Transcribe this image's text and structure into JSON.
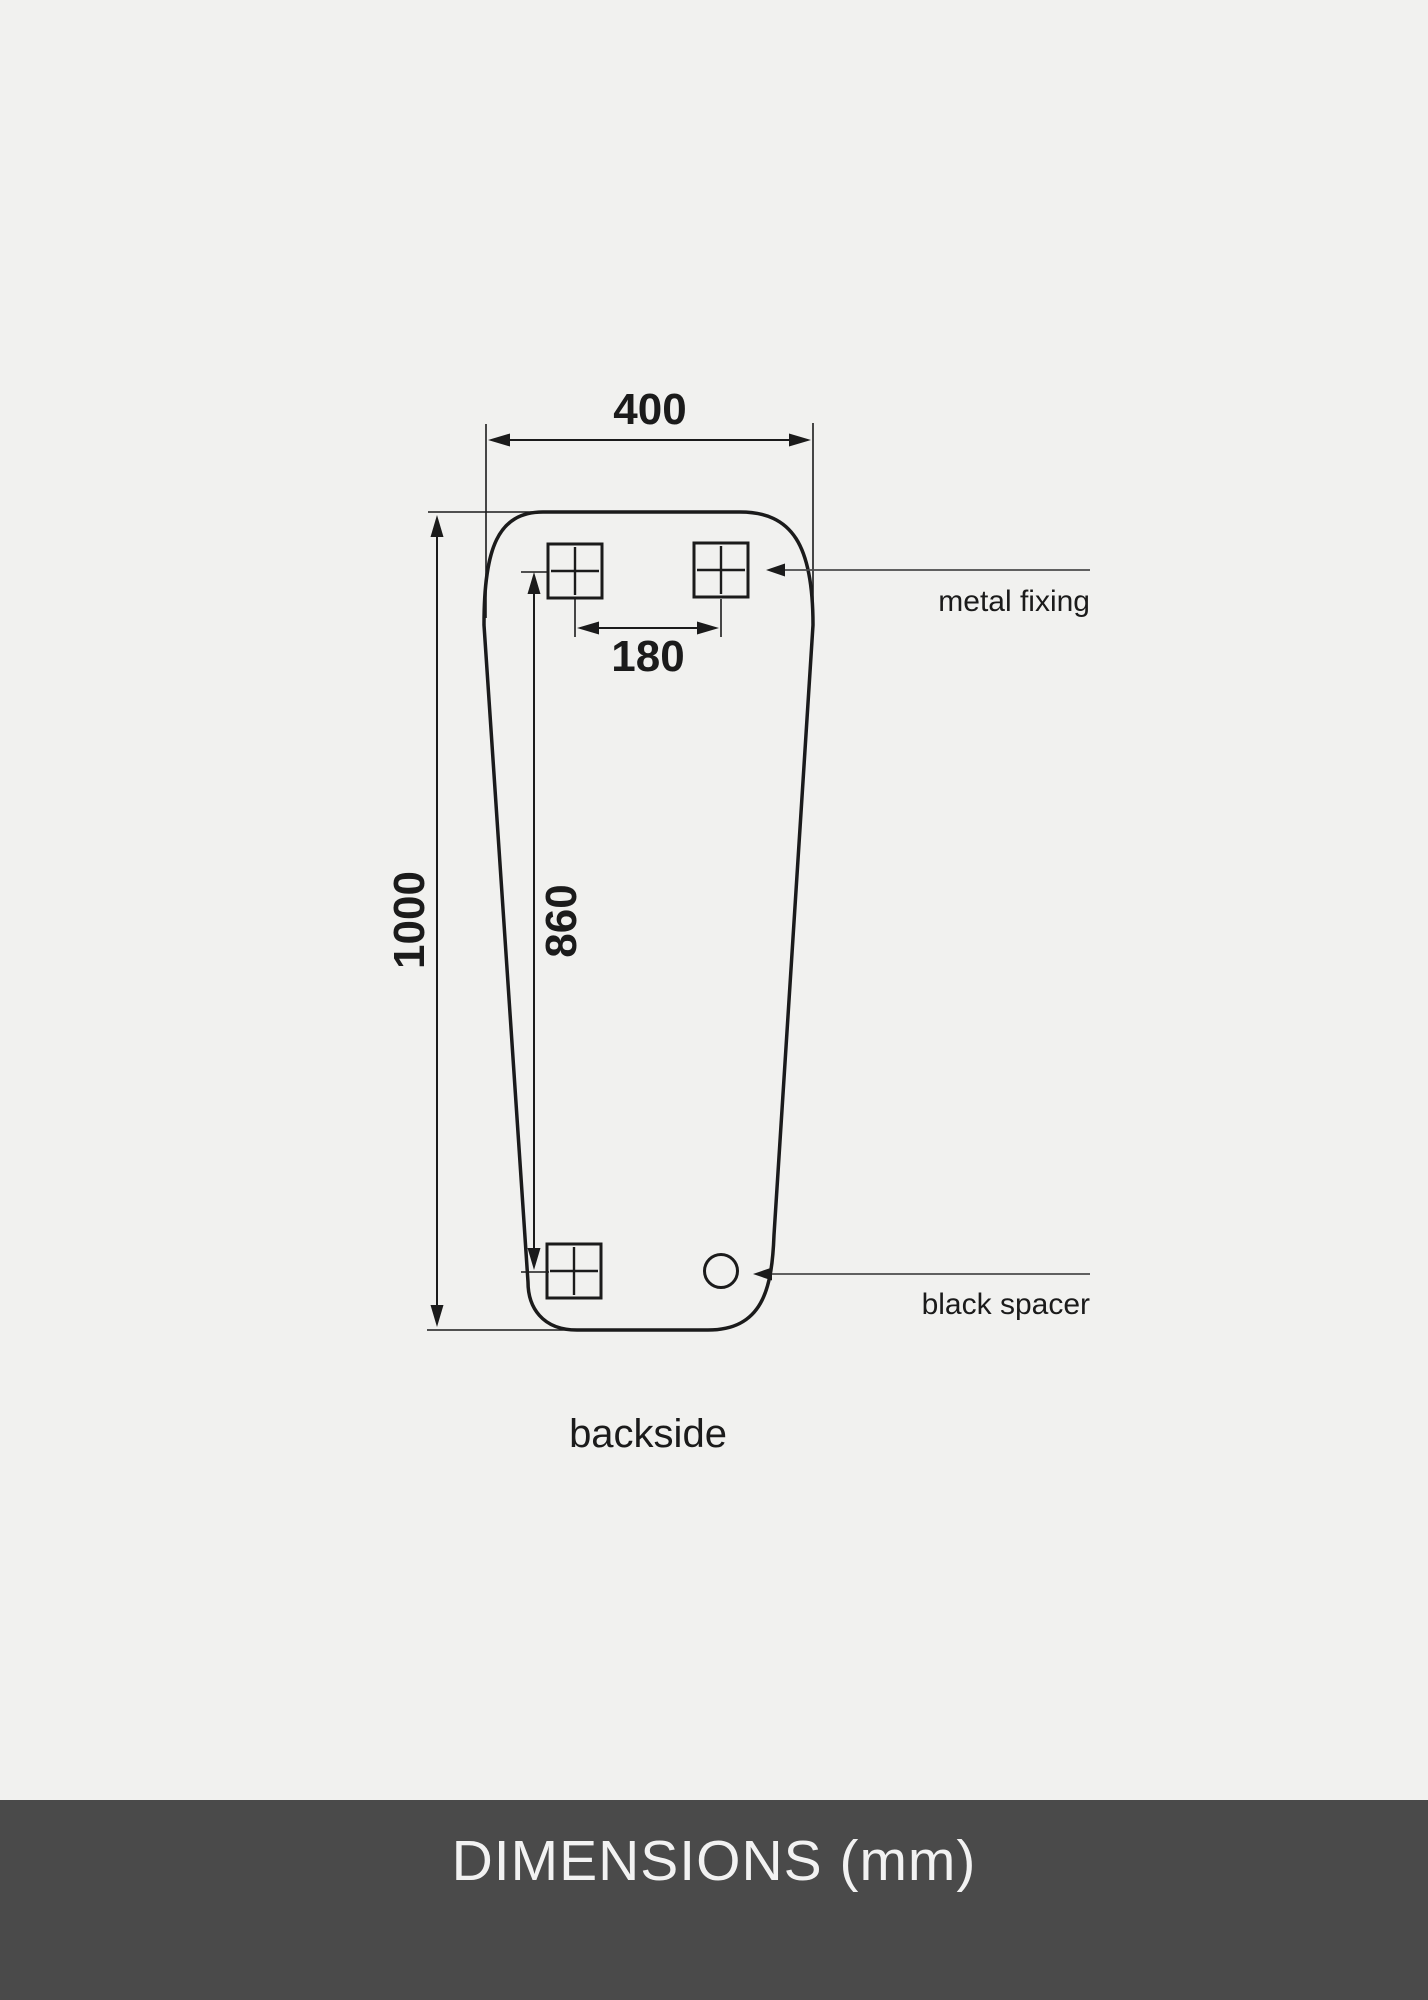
{
  "page": {
    "background": "#f1f1ef"
  },
  "diagram": {
    "view_label": "backside",
    "dimensions": {
      "top_width": "400",
      "fixing_spacing": "180",
      "overall_height": "1000",
      "fixing_vertical_span": "860"
    },
    "annotations": {
      "metal_fixing": "metal fixing",
      "black_spacer": "black spacer"
    },
    "colors": {
      "outline": "#1b1b1b",
      "leader_line": "#4b4b4b"
    }
  },
  "footer": {
    "title": "DIMENSIONS (mm)",
    "background": "#4a4a4a",
    "text_color": "#f2f2f2"
  }
}
